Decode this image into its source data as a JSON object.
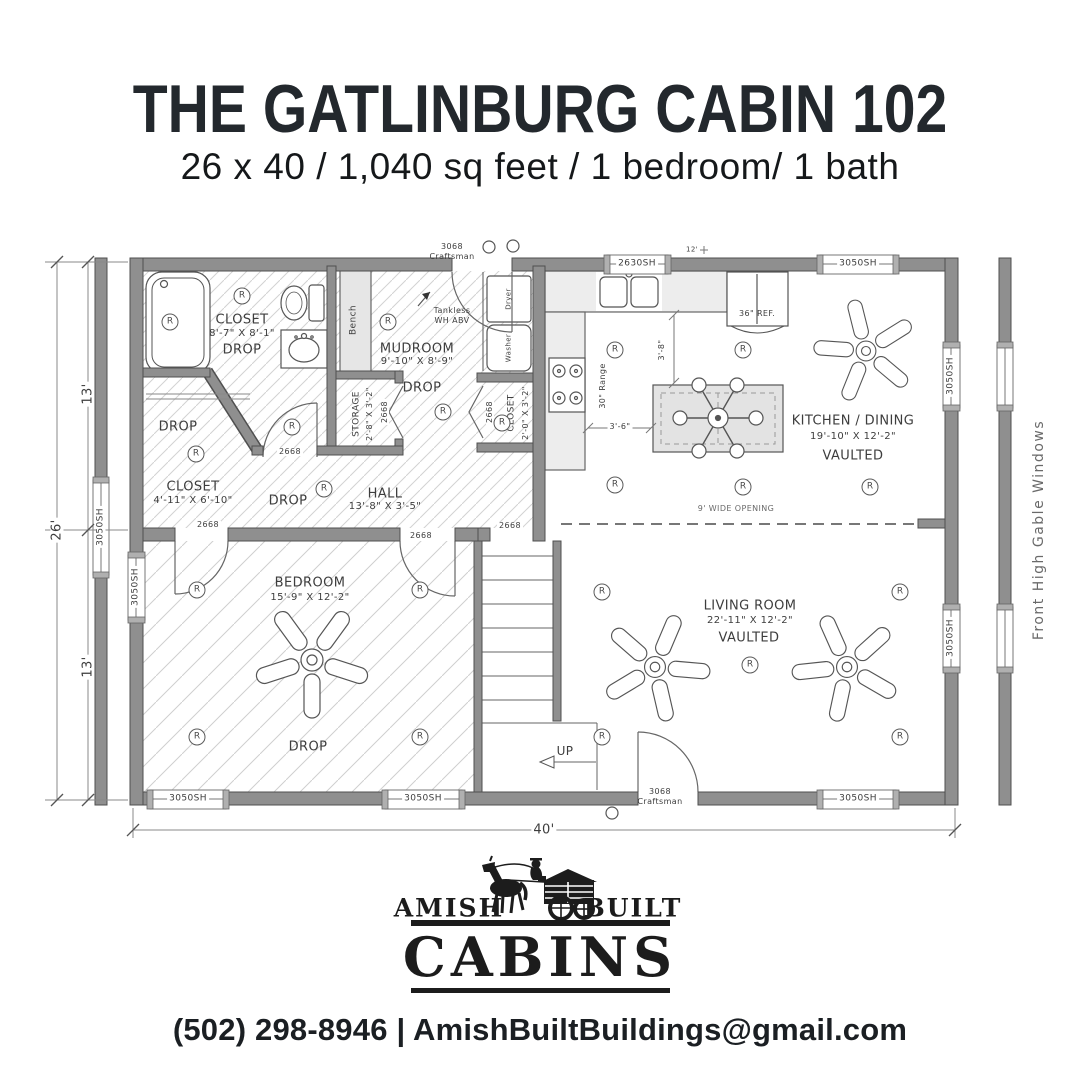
{
  "header": {
    "title": "THE GATLINBURG CABIN 102",
    "subtitle": "26 x 40 / 1,040 sq feet / 1 bedroom/ 1 bath"
  },
  "plan": {
    "symbols": {
      "recessed": "R"
    },
    "rooms": {
      "bath": {
        "name": "CLOSET",
        "dims": "8'-7\" X 8'-1\"",
        "ceiling": "DROP"
      },
      "walkin": {
        "name": "CLOSET",
        "dims": "4'-11\" X 6'-10\"",
        "ceiling": "DROP"
      },
      "mudroom": {
        "name": "MUDROOM",
        "dims": "9'-10\" X 8'-9\"",
        "ceiling": "DROP"
      },
      "storage": {
        "name": "STORAGE",
        "dims": "2'-8\" X 3'-2\""
      },
      "closet_small": {
        "name": "CLOSET",
        "dims": "2'-0\" X 3'-2\""
      },
      "hall": {
        "name": "HALL",
        "dims": "13'-8\" X 3'-5\"",
        "ceiling": "DROP"
      },
      "kitchen": {
        "name": "KITCHEN / DINING",
        "dims": "19'-10\" X 12'-2\"",
        "ceiling": "VAULTED"
      },
      "living": {
        "name": "LIVING ROOM",
        "dims": "22'-11\" X 12'-2\"",
        "ceiling": "VAULTED"
      },
      "bedroom": {
        "name": "BEDROOM",
        "dims": "15'-9\" X 12'-2\"",
        "ceiling": "DROP"
      }
    },
    "fixtures": {
      "bench": "Bench",
      "tankless_line1": "Tankless",
      "tankless_line2": "WH ABV",
      "range": "30\" Range",
      "fridge": "36\" REF.",
      "dryer": "Dryer",
      "washer": "Washer",
      "stairs_up": "UP",
      "wide_opening": "9' WIDE OPENING"
    },
    "doors": {
      "exterior_size": "3068",
      "exterior_style": "Craftsman",
      "interior": "2668"
    },
    "windows": {
      "kitchen": "2630SH",
      "standard": "3050SH"
    },
    "dims": {
      "overall_width": "40'",
      "overall_depth": "26'",
      "half_depth": "13'",
      "counter_to_island": "3'-6\"",
      "wall_to_counter": "3'-8\"",
      "gable_height": "12'"
    },
    "notes": {
      "gable": "Front High Gable Windows"
    }
  },
  "footer": {
    "brand_left": "AMISH",
    "brand_right": "BUILT",
    "brand_main": "CABINS",
    "contact": "(502) 298-8946 | AmishBuiltBuildings@gmail.com"
  }
}
